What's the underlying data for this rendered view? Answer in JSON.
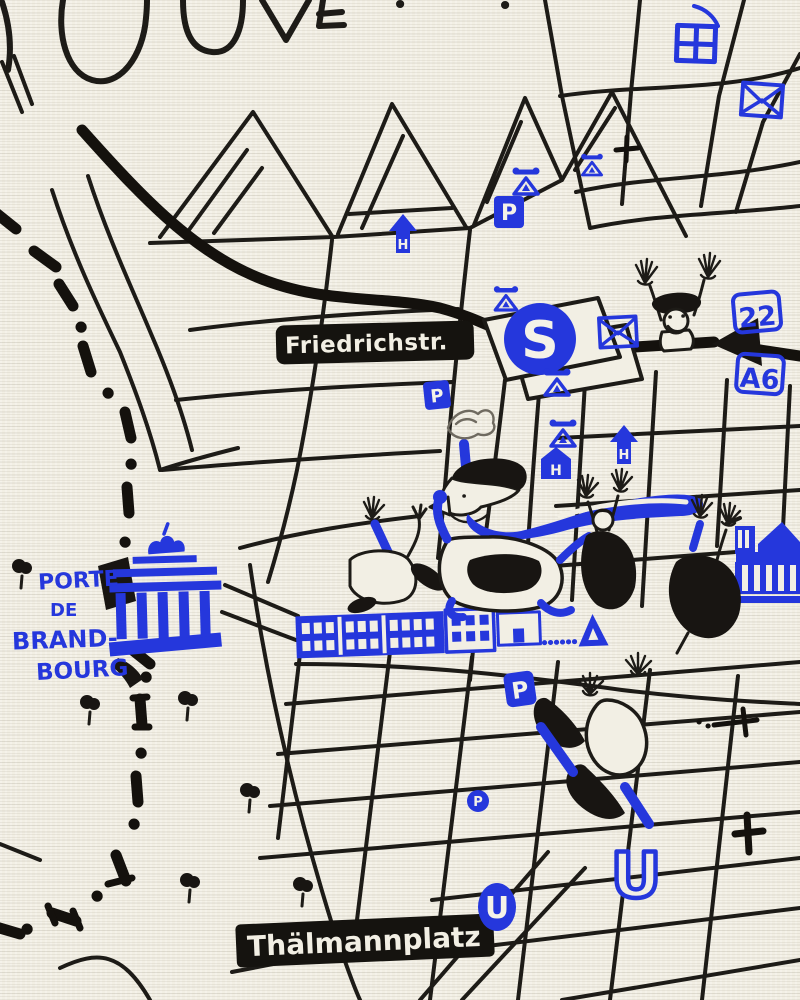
{
  "canvas": {
    "paper_color": "#f2efe4",
    "ink_color": "#1d1b17",
    "accent_blue": "#2537dc"
  },
  "lettering": {
    "title_fragment": "OUVE",
    "title_exclamation": "!"
  },
  "labels": {
    "street": "Friedrichstr.",
    "square": "Thälmannplatz",
    "gate_lines": [
      "PORTE",
      "DE",
      "BRAND-",
      "BOURG"
    ]
  },
  "badges": {
    "badge_22": "22",
    "badge_a6": "A6"
  },
  "transit": {
    "sbahn": "S",
    "ubahn": "U",
    "parking": "P",
    "hotel": "H"
  },
  "icons": {
    "sbahn-station": "white S on blue disc over tilted white box",
    "ubahn-station": "blue U letter",
    "parking": "white P on blue square",
    "hotel": "white H in blue up-arrow / blue house",
    "telephone": "blue triangle with handset",
    "post-office": "blue envelope",
    "department-store": "blue grid square",
    "church": "black cross",
    "tree": "black round tree with trunk",
    "berlin-wall": "black dash-dot line",
    "railway": "thick black line with arrowhead"
  },
  "drawings": {
    "gate": "Brandenburg Gate drawn in blue",
    "linden_facade": "long blue building facades with windows",
    "palace": "blue palace facade with pediment and columns",
    "crowd": "cartoon figures celebrating on the avenue",
    "climber": "figure with raised arms behind the railway line",
    "tumbler": "figure tumbling across the street grid"
  }
}
